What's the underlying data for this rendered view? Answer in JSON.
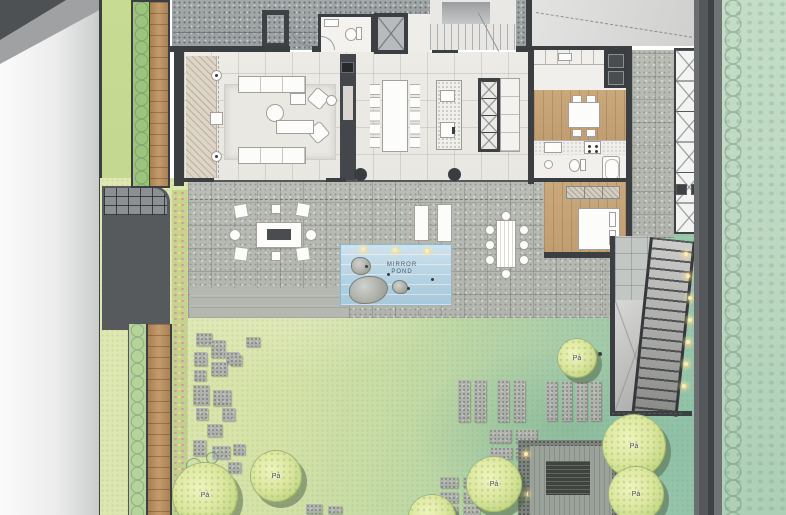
{
  "plan": {
    "pond_label": {
      "line1": "MIRROR",
      "line2": "POND"
    },
    "trees": [
      {
        "label": "Pá"
      },
      {
        "label": "Pá"
      },
      {
        "label": "Pá"
      },
      {
        "label": "Pá"
      },
      {
        "label": "Pá"
      },
      {
        "label": "Pá"
      }
    ]
  },
  "colors": {
    "wall": "#3c3f41",
    "terrace": "#b8bcb4",
    "lawn-light": "#d9e5ac",
    "lawn-teal": "#93c3ab",
    "pond-water": "#b7d5e5",
    "wood-floor": "#c9a87c",
    "wood-deck": "#b48c5e",
    "canopy": "#dce79f",
    "hedge": "#bdd8c2",
    "light-accent": "#ffedb0",
    "road": "#e9ebeb"
  }
}
